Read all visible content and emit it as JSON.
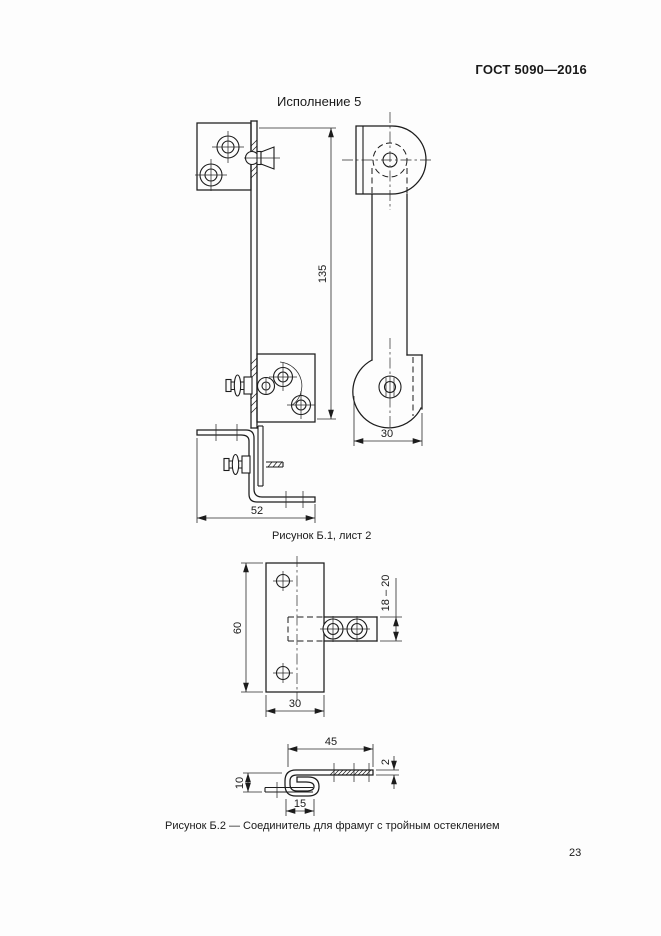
{
  "document": {
    "header": "ГОСТ 5090—2016",
    "page_number": "23"
  },
  "figure_b1": {
    "title": "Исполнение 5",
    "caption": "Рисунок Б.1, лист 2",
    "dims": {
      "bar_length": "135",
      "strap_width": "30",
      "bracket_width": "52"
    }
  },
  "figure_b2": {
    "caption": "Рисунок Б.2 — Соединитель для фрамуг с тройным остеклением",
    "dims": {
      "plate_height": "60",
      "plate_width": "30",
      "slot_range": "18 – 20",
      "arm_length": "45",
      "thickness": "2",
      "hook_height": "10",
      "fold_width": "15"
    }
  }
}
